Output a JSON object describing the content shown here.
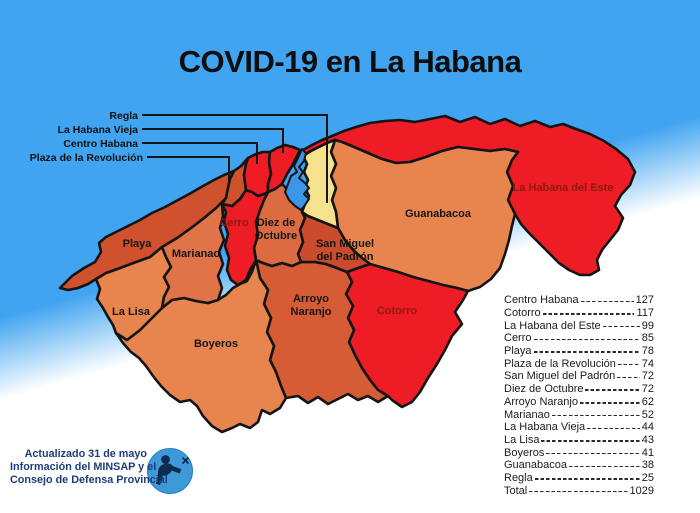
{
  "title": "COVID-19 en La Habana",
  "colors": {
    "sea": "#41a4f0",
    "bay": "#3d95e8",
    "border": "#141414",
    "map_label": "#151515",
    "dark_red_label": "#8c1a10",
    "red": "#ee1c25",
    "yellow": "#f6e28c",
    "attribution_text": "#1d3d7a",
    "logo_blue": "#3e9ad7",
    "logo_dark": "#0c2b4e"
  },
  "map": {
    "regions": [
      {
        "id": "la-habana-del-este",
        "name": "La Habana del Este",
        "cases": 99,
        "color": "#ee1c25",
        "path": "M303,150 L312,145 322,140 332,136 344,131 356,127 370,123 385,121 400,120 415,122 430,119 445,116 460,122 475,117 490,124 505,119 520,126 535,121 550,127 563,124 576,129 590,134 604,141 L616,149 628,159 635,172 630,185 621,195 615,206 623,218 618,230 610,240 602,250 597,260 599,270 590,275 580,275 569,270 559,263 549,253 539,243 529,233 521,224 515,214 L508,200 513,186 507,172 512,160 518,152 L505,149 490,151 474,149 458,147 442,151 426,157 410,162 396,163 382,159 368,153 354,147 342,142 335,140 L327,143 319,147 311,151 303,156 Z",
        "label": {
          "x": 563,
          "y": 191,
          "lines": [
            "La Habana del Este"
          ],
          "color": "#8c1a10"
        }
      },
      {
        "id": "guanabacoa",
        "name": "Guanabacoa",
        "cases": 38,
        "color": "#e8854e",
        "path": "M335,140 L331,152 336,164 331,176 336,188 332,200 336,212 338,228 L345,240 353,250 362,258 370,264 L384,268 398,272 413,277 428,281 443,285 457,288 468,291 L480,287 491,279 500,268 505,254 509,240 512,226 515,214 L508,200 513,186 507,172 512,160 518,152 L505,149 490,151 474,149 458,147 442,151 426,157 410,162 396,163 382,159 368,153 354,147 342,142 Z",
        "label": {
          "x": 438,
          "y": 217,
          "lines": [
            "Guanabacoa"
          ]
        }
      },
      {
        "id": "cotorro",
        "name": "Cotorro",
        "cases": 117,
        "color": "#ee1c25",
        "path": "M347,272 L358,268 370,264 L384,268 398,272 413,277 428,281 443,285 457,288 468,291 L463,300 455,312 462,324 452,336 445,350 437,364 428,378 420,392 412,402 402,407 392,400 388,396 L378,390 370,380 362,368 355,355 349,342 L354,330 348,318 353,306 346,294 352,282 Z",
        "label": {
          "x": 397,
          "y": 314,
          "lines": [
            "Cotorro"
          ],
          "color": "#8c1a10"
        }
      },
      {
        "id": "arroyo-naranjo",
        "name": "Arroyo Naranjo",
        "cases": 62,
        "color": "#d55c35",
        "path": "M256,260 L263,263 272,266 282,263 292,266 301,262 L308,262 315,262 326,264 337,268 347,272 L352,282 346,294 353,306 348,318 354,330 349,342 L355,355 362,368 370,380 378,390 388,396 L378,402 368,396 358,400 348,394 338,399 328,404 318,397 308,403 298,396 286,398 L281,386 276,372 270,360 274,346 267,332 271,318 264,304 268,290 260,278 Z",
        "label": {
          "x": 311,
          "y": 302,
          "lines": [
            "Arroyo",
            "Naranjo"
          ]
        }
      },
      {
        "id": "boyeros",
        "name": "Boyeros",
        "cases": 41,
        "color": "#e8854e",
        "path": "M162,308 L172,300 184,298 196,301 208,303 218,300 L226,295 233,288 240,284 247,281 252,272 256,260 L260,278 268,290 264,304 271,318 267,332 274,346 270,360 276,372 281,386 286,398 L280,408 270,414 262,410 258,422 250,428 240,424 232,428 222,432 212,426 203,416 197,406 190,400 180,402 170,395 161,386 153,376 146,366 139,358 131,352 123,343 116,333 L127,340 140,330 152,318 Z",
        "label": {
          "x": 216,
          "y": 347,
          "lines": [
            "Boyeros"
          ]
        }
      },
      {
        "id": "la-lisa",
        "name": "La Lisa",
        "cases": 43,
        "color": "#e8854e",
        "path": "M162,247 L150,257 136,262 120,268 106,273 96,279 L100,289 97,299 103,308 108,317 113,325 116,333 L127,340 140,330 152,318 162,308 L164,297 169,287 164,277 171,267 166,257 Z",
        "label": {
          "x": 131,
          "y": 315,
          "lines": [
            "La Lisa"
          ]
        }
      },
      {
        "id": "marianao",
        "name": "Marianao",
        "cases": 52,
        "color": "#e07347",
        "path": "M226,198 L216,208 204,218 191,228 177,238 162,247 L166,257 171,267 164,277 169,287 164,297 162,308 L172,300 184,298 196,301 208,303 218,300 L222,288 218,276 223,264 219,252 224,240 220,228 223,216 222,204 Z",
        "label": {
          "x": 196,
          "y": 257,
          "lines": [
            "Marianao"
          ]
        }
      },
      {
        "id": "playa",
        "name": "Playa",
        "cases": 78,
        "color": "#d0512e",
        "path": "M60,288 L72,276 84,268 95,262 101,252 99,243 106,237 116,232 128,226 140,220 152,213 165,207 178,200 191,193 203,186 214,180 224,175 234,171 L230,179 228,188 226,198 216,208 204,218 191,228 177,238 162,247 150,257 136,262 120,268 106,273 96,279 88,284 78,288 68,290 Z",
        "label": {
          "x": 137,
          "y": 247,
          "lines": [
            "Playa"
          ]
        }
      },
      {
        "id": "san-miguel-del-padron",
        "name": "San Miguel del Padrón",
        "cases": 72,
        "color": "#cb4c2d",
        "path": "M302,212 L308,216 318,220 328,224 338,228 L345,240 353,250 362,258 370,264 L358,268 347,272 L337,268 326,264 315,262 308,262 301,262 L298,254 303,242 300,230 305,218 Z",
        "label": {
          "x": 345,
          "y": 247,
          "lines": [
            "San Miguel",
            "del Padrón"
          ]
        }
      },
      {
        "id": "diez-de-octubre",
        "name": "Diez de Octubre",
        "cases": 72,
        "color": "#dd6b41",
        "path": "M268,192 L275,189 282,184 L288,190 294,197 300,204 302,212 L305,218 300,230 303,242 298,254 301,262 L292,266 282,263 272,266 263,263 256,260 L254,248 258,235 256,222 260,210 264,200 Z",
        "label": {
          "x": 276,
          "y": 226,
          "lines": [
            "Diez de",
            "Octubre"
          ]
        }
      },
      {
        "id": "cerro",
        "name": "Cerro",
        "cases": 85,
        "color": "#ee1c25",
        "path": "M246,190 L252,192 258,196 264,194 268,192 L264,200 260,210 256,222 258,235 254,248 256,260 L250,270 246,280 238,285 231,280 227,270 229,258 225,246 228,234 224,222 226,212 222,204 L232,206 240,199 Z",
        "label": {
          "x": 234,
          "y": 226,
          "lines": [
            "Cerro"
          ],
          "color": "#8c1a10"
        }
      },
      {
        "id": "plaza-de-la-revolucion",
        "name": "Plaza de la Revolución",
        "cases": 74,
        "color": "#d0512e",
        "path": "M234,171 L241,166 248,158 L246,164 244,175 246,190 L240,199 232,206 222,204 L226,198 228,188 230,179 Z"
      },
      {
        "id": "centro-habana",
        "name": "Centro Habana",
        "cases": 127,
        "color": "#ee1c25",
        "path": "M248,158 L256,154 263,152 270,152 L269,162 271,174 268,184 268,192 L264,194 258,196 252,192 246,190 L244,175 246,164 Z"
      },
      {
        "id": "la-habana-vieja",
        "name": "La Habana Vieja",
        "cases": 44,
        "color": "#ee1c25",
        "path": "M270,152 L277,148 285,145 293,147 300,150 L296,158 292,166 287,174 282,184 L275,189 268,192 L268,184 271,174 269,162 Z"
      },
      {
        "id": "regla",
        "name": "Regla",
        "cases": 25,
        "color": "#f6e28c",
        "path": "M303,156 L311,151 319,147 327,143 335,140 L331,152 336,164 331,176 336,188 332,200 336,212 338,228 L328,224 318,220 308,216 302,212 L305,204 309,196 305,188 308,180 304,172 307,164 Z"
      }
    ],
    "bay": {
      "name": "Bahía de La Habana",
      "path": "M302,149 L298,158 294,166 297,172 291,176 288,184 285,192 289,200 295,206 301,210 305,205 309,199 304,194 309,188 305,183 299,178 303,172 299,167 304,161 306,153 Z"
    },
    "callouts": [
      {
        "id": "regla",
        "label": "Regla",
        "x": 138,
        "y": 119,
        "line": "142,115 327,115 327,203"
      },
      {
        "id": "la-habana-vieja",
        "label": "La Habana Vieja",
        "x": 138,
        "y": 133,
        "line": "142,129 283,129 283,153"
      },
      {
        "id": "centro-habana",
        "label": "Centro Habana",
        "x": 138,
        "y": 147,
        "line": "142,143 257,143 257,164"
      },
      {
        "id": "plaza-de-la-revolucion",
        "label": "Plaza de la Revolución",
        "x": 143,
        "y": 161,
        "line": "147,157 229,157 229,181"
      }
    ]
  },
  "stats": {
    "rows": [
      {
        "name": "Centro Habana",
        "value": "127"
      },
      {
        "name": "Cotorro",
        "value": "117"
      },
      {
        "name": "La Habana del Este",
        "value": "99"
      },
      {
        "name": "Cerro",
        "value": "85"
      },
      {
        "name": "Playa",
        "value": "78"
      },
      {
        "name": "Plaza de la Revolución",
        "value": "74"
      },
      {
        "name": "San Miguel del Padrón",
        "value": "72"
      },
      {
        "name": "Diez de Octubre",
        "value": "72"
      },
      {
        "name": "Arroyo Naranjo",
        "value": "62"
      },
      {
        "name": "Marianao",
        "value": "52"
      },
      {
        "name": "La Habana Vieja",
        "value": "44"
      },
      {
        "name": "La Lisa",
        "value": "43"
      },
      {
        "name": "Boyeros",
        "value": "41"
      },
      {
        "name": "Guanabacoa",
        "value": "38"
      },
      {
        "name": "Regla",
        "value": "25"
      },
      {
        "name": "Total",
        "value": "1029"
      }
    ]
  },
  "attribution": {
    "line1": "Actualizado 31 de mayo",
    "line2": "Información del MINSAP y el",
    "line3": "Consejo de Defensa Provincial"
  }
}
